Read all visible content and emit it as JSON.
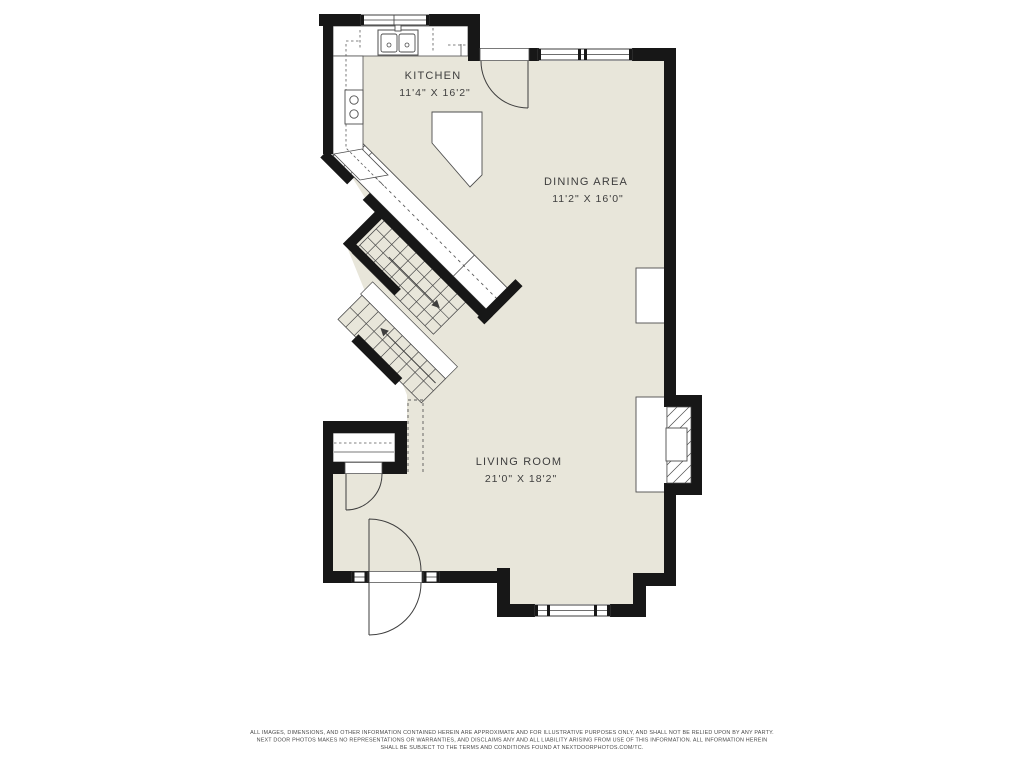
{
  "floorplan": {
    "colors": {
      "floor": "#e8e6da",
      "wall": "#171717",
      "thin_line": "#4d4d4d",
      "label_text": "#3e3e3e"
    },
    "rooms": [
      {
        "id": "kitchen",
        "name": "KITCHEN",
        "dimensions": "11'4\" X 16'2\""
      },
      {
        "id": "dining",
        "name": "DINING AREA",
        "dimensions": "11'2\" X 16'0\""
      },
      {
        "id": "living",
        "name": "LIVING ROOM",
        "dimensions": "21'0\" X 18'2\""
      }
    ],
    "icons": [
      {
        "id": "stair-up-arrow",
        "meaning": "stairs going up"
      },
      {
        "id": "stair-down-arrow",
        "meaning": "stairs going down"
      }
    ]
  },
  "footer": {
    "lines": [
      "ALL IMAGES, DIMENSIONS, AND OTHER INFORMATION CONTAINED HEREIN ARE APPROXIMATE AND FOR ILLUSTRATIVE PURPOSES ONLY, AND SHALL NOT BE RELIED UPON BY ANY PARTY.",
      "NEXT DOOR PHOTOS MAKES NO REPRESENTATIONS OR WARRANTIES, AND DISCLAIMS ANY AND ALL LIABILITY ARISING FROM USE OF THIS INFORMATION. ALL INFORMATION HEREIN",
      "SHALL BE SUBJECT TO THE TERMS AND CONDITIONS FOUND AT NEXTDOORPHOTOS.COM/TC."
    ]
  }
}
